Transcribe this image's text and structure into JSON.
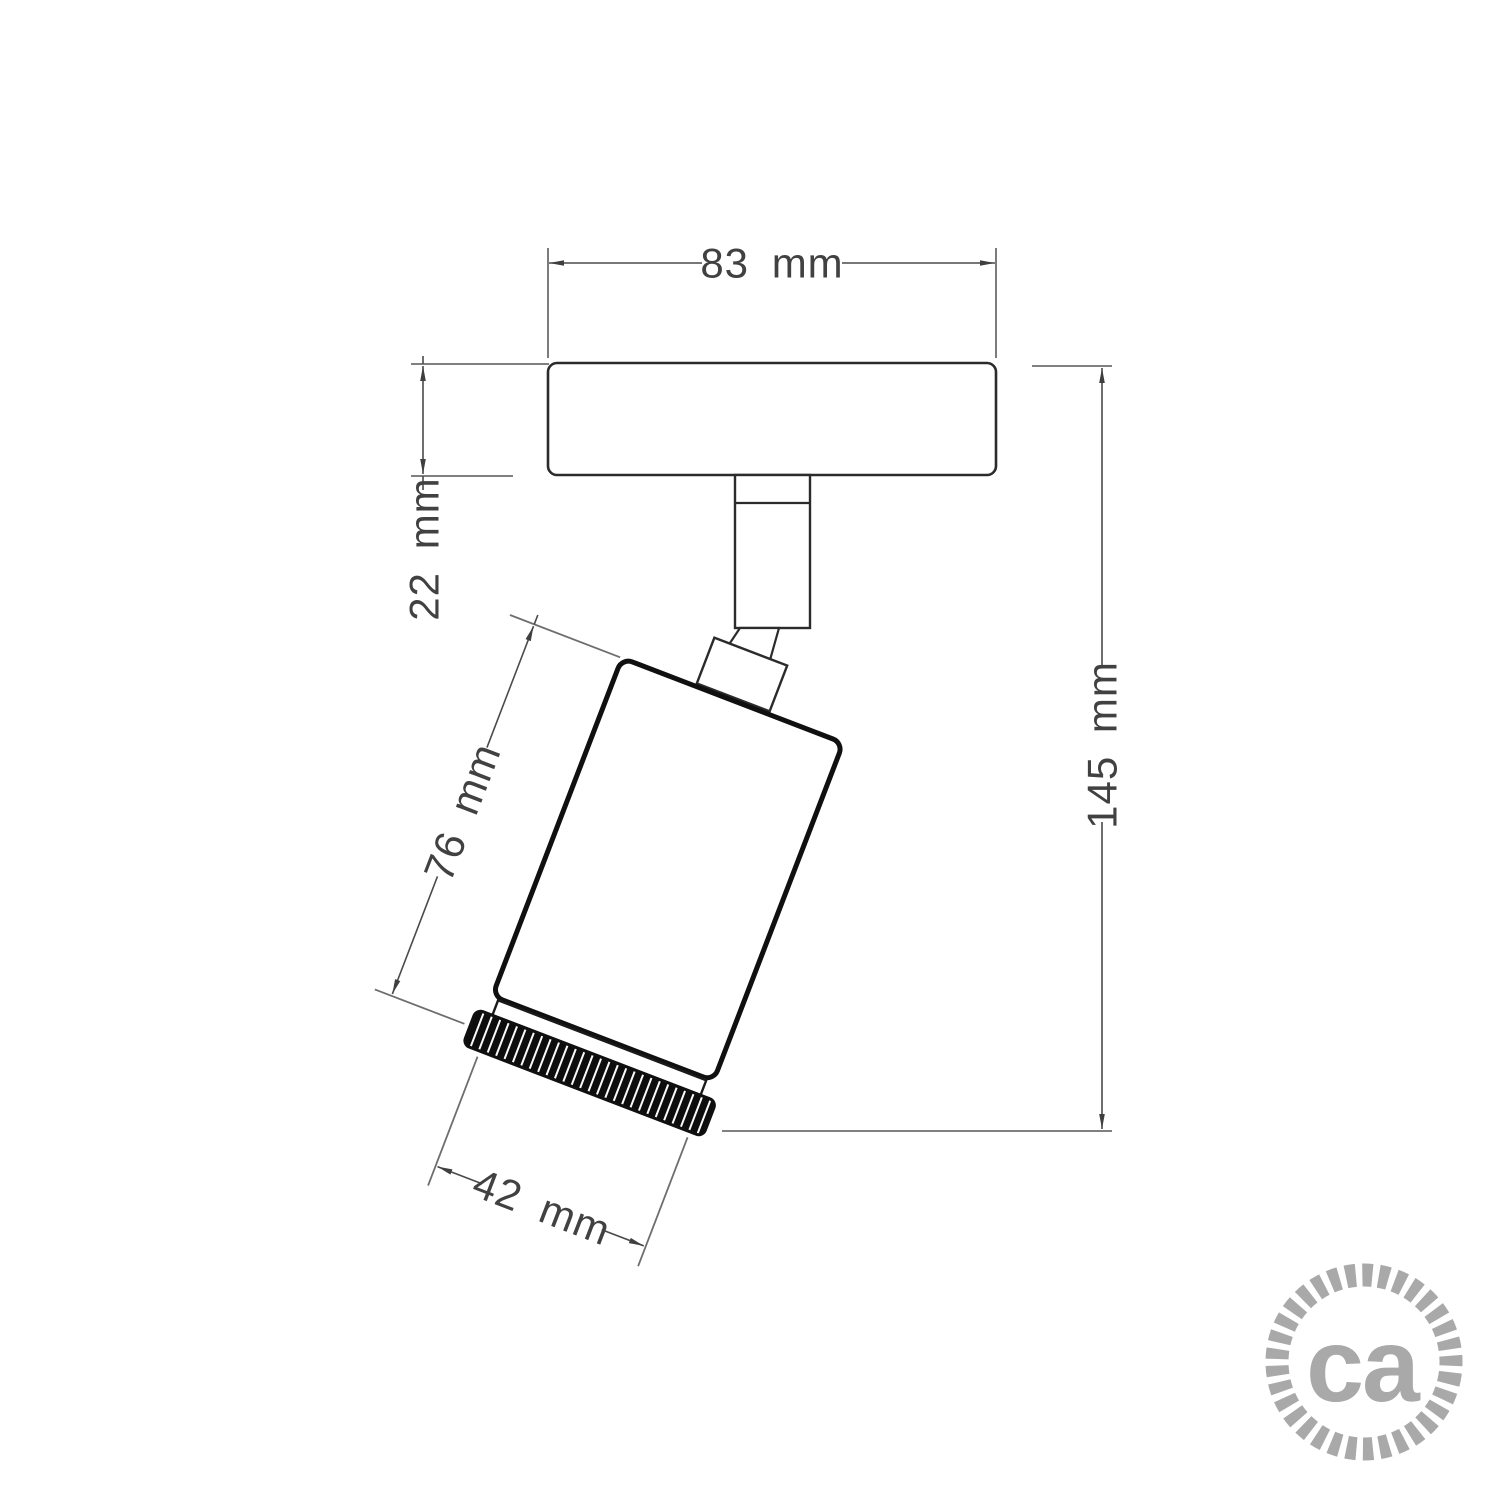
{
  "dims": {
    "base_width": {
      "label": "83 mm",
      "value_mm": 83
    },
    "base_thickness": {
      "label": "22 mm",
      "value_mm": 22
    },
    "overall_height": {
      "label": "145 mm",
      "value_mm": 145
    },
    "body_length": {
      "label": "76 mm",
      "value_mm": 76
    },
    "body_diameter": {
      "label": "42 mm",
      "value_mm": 42
    }
  },
  "logo": {
    "text": "ca"
  },
  "colors": {
    "background": "#ffffff",
    "object_line": "#2b2b2b",
    "body_line": "#101010",
    "dimension_line": "#4a4a4a",
    "extension_line": "#6e6e6e",
    "dimension_text": "#414141",
    "logo_gray": "#a9a9a9"
  }
}
